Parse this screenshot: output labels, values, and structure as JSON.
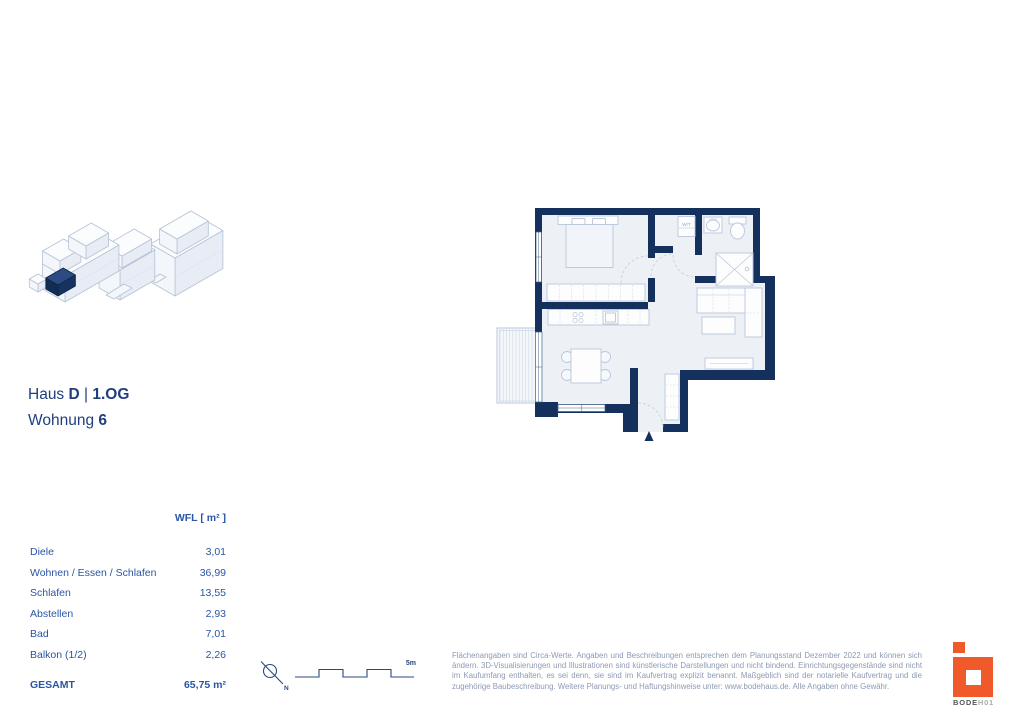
{
  "title": {
    "house_label": "Haus",
    "house_id": "D",
    "separator": "|",
    "floor": "1.OG",
    "unit_label": "Wohnung",
    "unit_number": "6"
  },
  "area_table": {
    "header": "WFL [ m² ]",
    "rows": [
      {
        "label": "Diele",
        "value": "3,01"
      },
      {
        "label": "Wohnen / Essen / Schlafen",
        "value": "36,99"
      },
      {
        "label": "Schlafen",
        "value": "13,55"
      },
      {
        "label": "Abstellen",
        "value": "2,93"
      },
      {
        "label": "Bad",
        "value": "7,01"
      },
      {
        "label": "Balkon (1/2)",
        "value": "2,26"
      }
    ],
    "total_label": "GESAMT",
    "total_value": "65,75 m²"
  },
  "plan": {
    "washer_label": "W/T"
  },
  "scalebar": {
    "length_label": "5m",
    "north_label": "N"
  },
  "disclaimer": "Flächenangaben sind Circa-Werte. Angaben und Beschreibungen entsprechen dem Planungsstand Dezember 2022 und können sich ändern. 3D-Visualisierungen und Illustrationen sind künstlerische Darstellungen und nicht bindend. Einrichtungsgegenstände sind nicht im Kaufumfang enthalten, es sei denn, sie sind im Kaufvertrag explizit benannt. Maßgeblich sind der notarielle Kaufvertrag und die zugehörige Baubeschreibung. Weitere Planungs- und Haftungshinweise unter: www.bodehaus.de. Alle Angaben ohne Gewähr.",
  "logo": {
    "word_primary": "BODE",
    "word_secondary": "H01"
  },
  "colors": {
    "wall_navy": "#14305c",
    "title_blue": "#203e7e",
    "table_blue": "#2a55a3",
    "logo_orange": "#f05a2b",
    "floor_fill": "#edf1f6",
    "furniture_line": "#b9c7db",
    "muted_text": "#8d9ab3"
  }
}
